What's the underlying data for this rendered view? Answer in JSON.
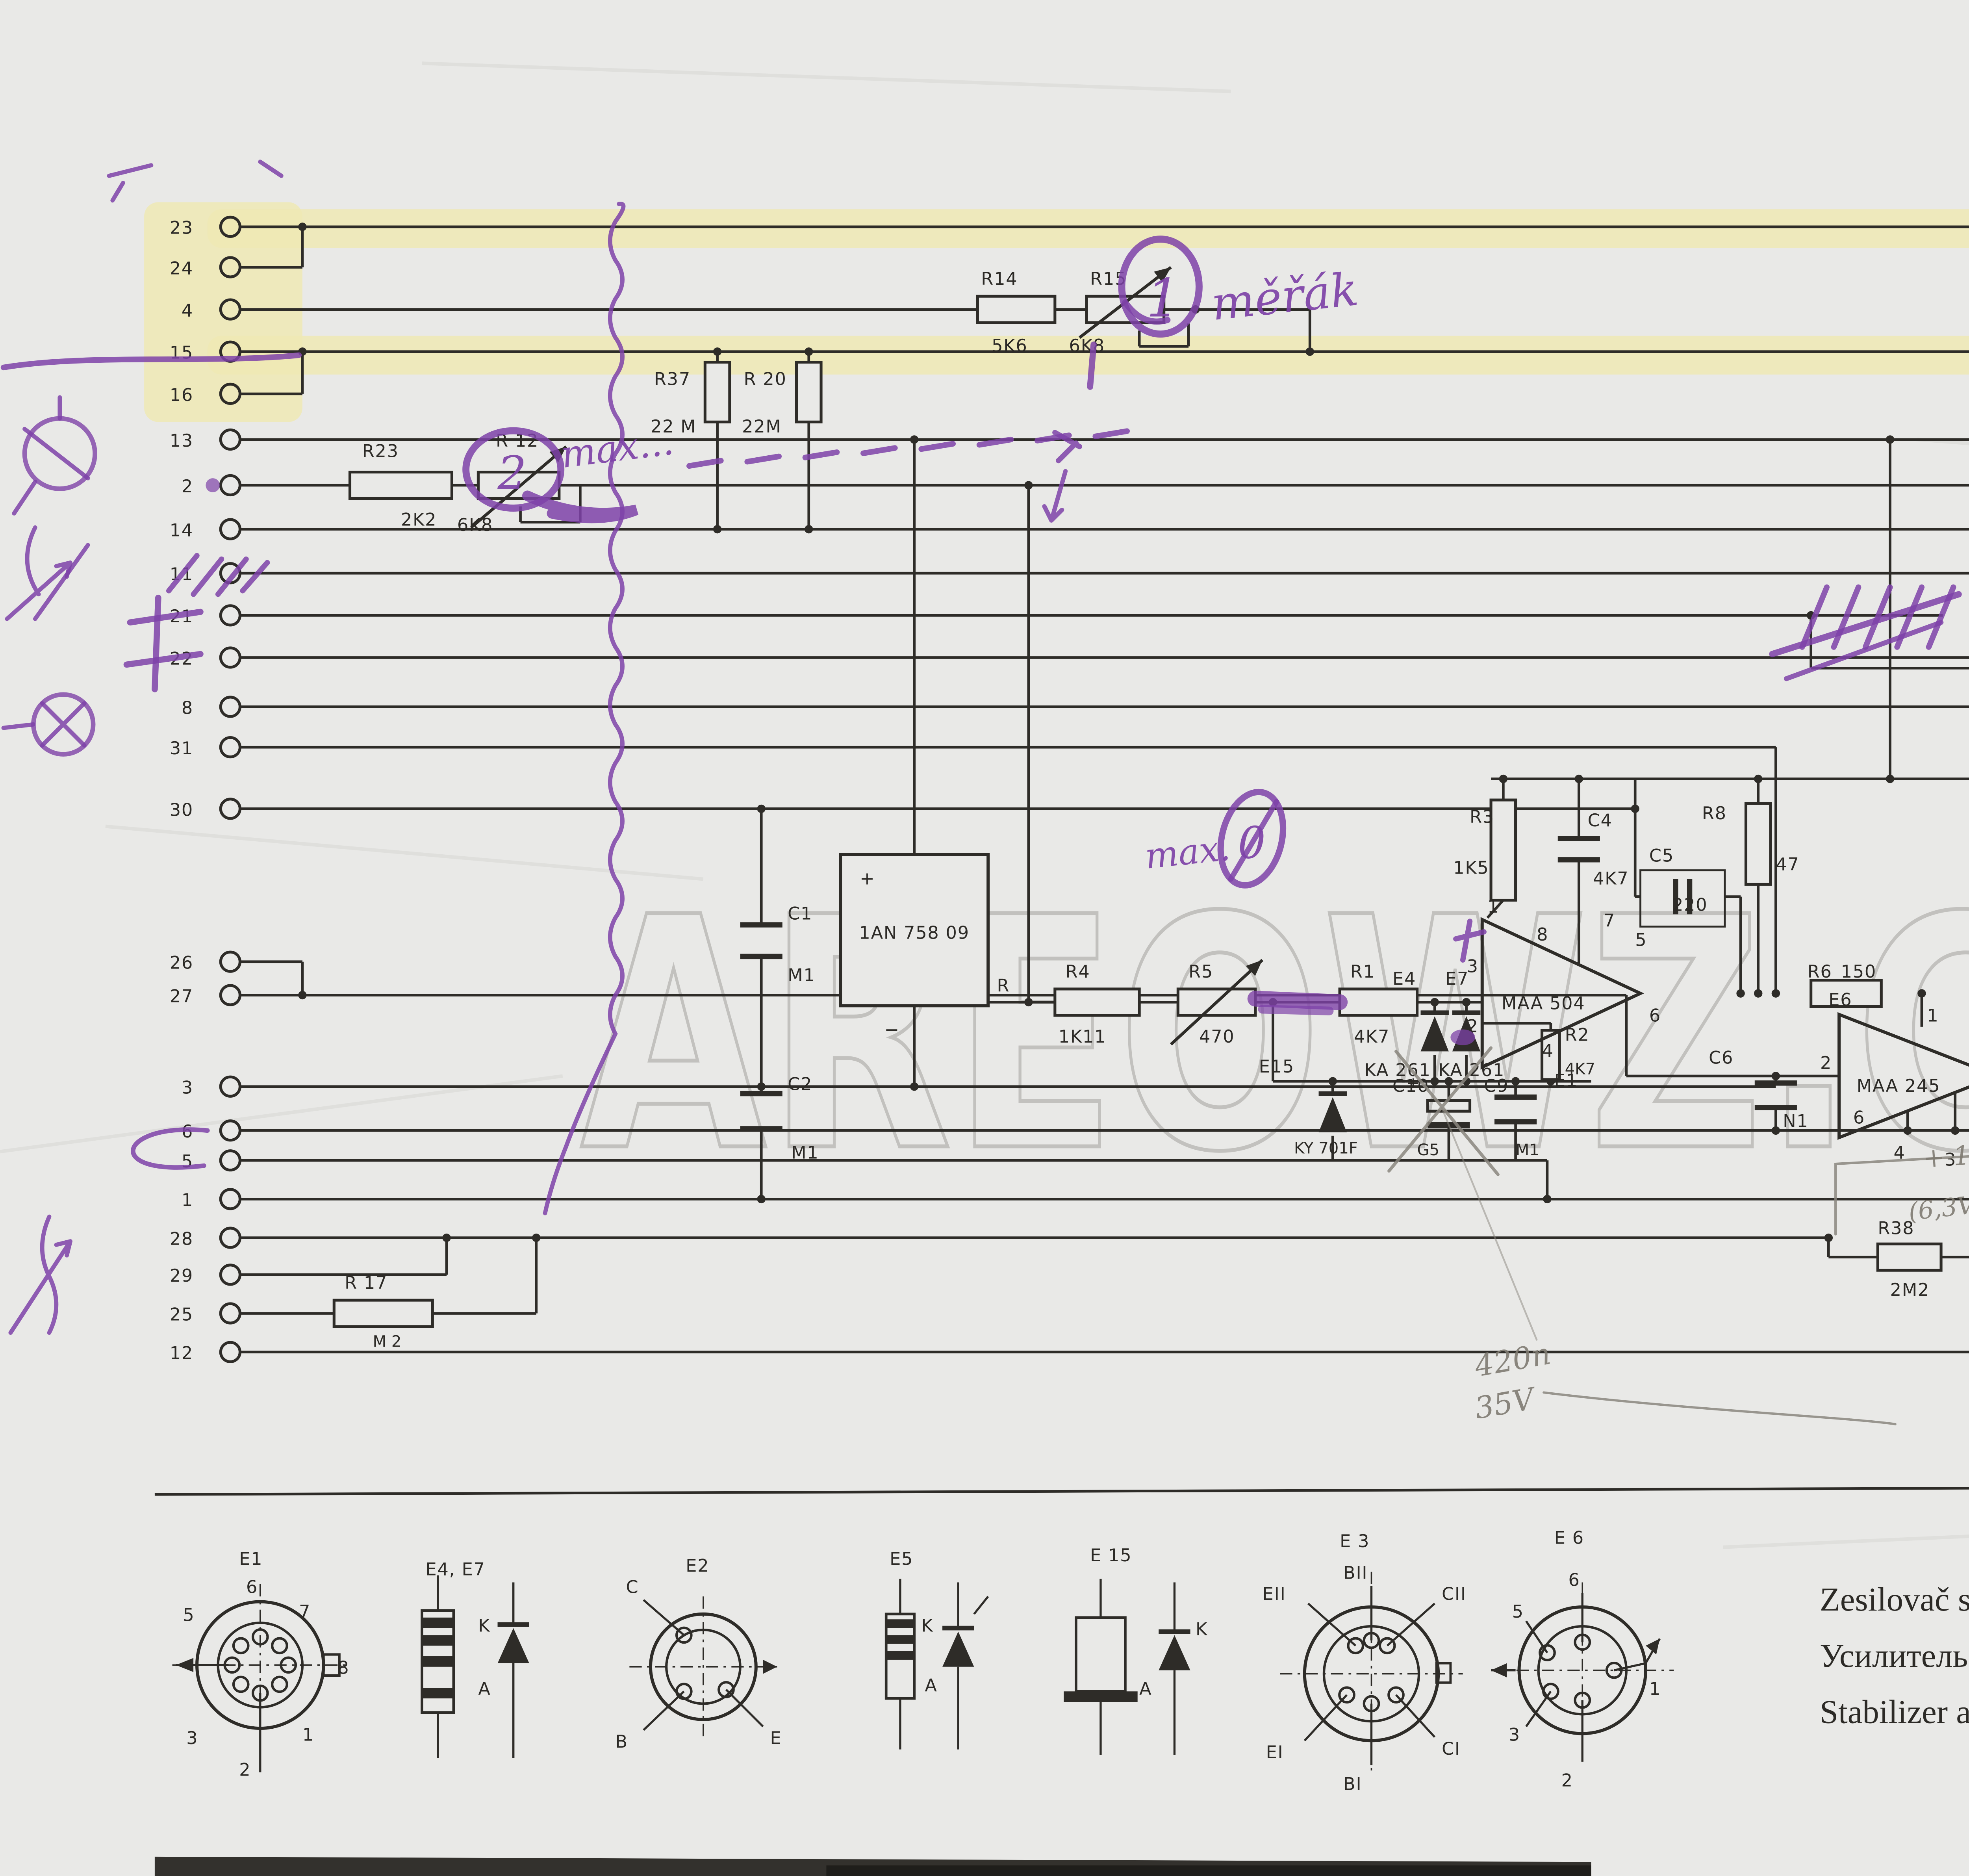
{
  "watermark": "AREOWZ.CZ",
  "pins": {
    "labels": [
      "23",
      "24",
      "4",
      "15",
      "16",
      "13",
      "2",
      "14",
      "11",
      "21",
      "22",
      "8",
      "31",
      "30",
      "26",
      "27",
      "3",
      "6",
      "5",
      "1",
      "28",
      "29",
      "25",
      "12"
    ]
  },
  "components": {
    "R14": {
      "name": "R14",
      "value": "5K6"
    },
    "R15": {
      "name": "R15",
      "value": "6K8"
    },
    "R37": {
      "name": "R37",
      "value": "22 M"
    },
    "R20": {
      "name": "R 20",
      "value": "22M"
    },
    "R23": {
      "name": "R23",
      "value": "2K2"
    },
    "R12": {
      "name": "R 12",
      "value": "6K8"
    },
    "R16": {
      "name": "R 16",
      "value": "2J2"
    },
    "R13": {
      "name": "R 13",
      "value": "100"
    },
    "R22": {
      "name": "R 22",
      "value": "2J2"
    },
    "R10": {
      "name": "R 10",
      "value": "220"
    },
    "R9": {
      "name": "R9",
      "value": "2K2"
    },
    "R4": {
      "name": "R4",
      "value": "1K11"
    },
    "R5": {
      "name": "R5",
      "value": "470"
    },
    "R1": {
      "name": "R1",
      "value": "4K7"
    },
    "R2": {
      "name": "R2",
      "value": "4K7"
    },
    "R3": {
      "name": "R3",
      "value": "1K5"
    },
    "R6": {
      "name": "R6",
      "value": "150"
    },
    "R7": {
      "name": "R7",
      "value": "270"
    },
    "R8": {
      "name": "R8",
      "value": "47"
    },
    "R38": {
      "name": "R38",
      "value": "2M2"
    },
    "R17": {
      "name": "R 17",
      "value": "M 2"
    },
    "C1": {
      "name": "C1",
      "value": "M1"
    },
    "C2": {
      "name": "C2",
      "value": "M1"
    },
    "C4": {
      "name": "C4",
      "value": "4K7"
    },
    "C5": {
      "name": "C5",
      "value": "220"
    },
    "C6": {
      "name": "C6",
      "value": "N1"
    },
    "C7": {
      "name": "C7",
      "value": "47"
    },
    "C8": {
      "name": "C8",
      "value": "4K7"
    },
    "C9": {
      "name": "C9",
      "value": "M1"
    },
    "C10": {
      "name": "C10",
      "value": "G5"
    },
    "IC": {
      "name": "1AN 758 09"
    },
    "E1": {
      "name": "E1",
      "value": "MAA 504"
    },
    "E2": {
      "name": "E2",
      "value": "KF508"
    },
    "E3": {
      "name": "E3",
      "value": "KC 510"
    },
    "E4": {
      "name": "E4",
      "value": "KA 261"
    },
    "E5": {
      "name": "E5",
      "value": "KZ 141"
    },
    "E6": {
      "name": "E6",
      "value": "MAA 245"
    },
    "E7": {
      "name": "E7",
      "value": "KA 261"
    },
    "E15": {
      "name": "E15",
      "value": "KY 701F"
    }
  },
  "ic_marks": {
    "plus": "+",
    "minus": "−",
    "out": "R"
  },
  "ink": {
    "plus": "+"
  },
  "terminals": {
    "e1": [
      "1",
      "3",
      "2",
      "8",
      "7",
      "5",
      "6",
      "4"
    ],
    "e6": [
      "1",
      "2",
      "6",
      "4",
      "3",
      "5"
    ],
    "e3": [
      "KII",
      "KI",
      "BII",
      "BI",
      "EII",
      "EI"
    ]
  },
  "legend": {
    "e1": {
      "title": "E1",
      "pins": [
        "6",
        "5",
        "7",
        "8",
        "1",
        "3",
        "2"
      ]
    },
    "e4e7": {
      "title": "E4, E7",
      "k": "K",
      "a": "A"
    },
    "e2": {
      "title": "E2",
      "c": "C",
      "b": "B",
      "e": "E"
    },
    "e5": {
      "title": "E5",
      "k": "K",
      "a": "A"
    },
    "e15": {
      "title": "E 15",
      "k": "K",
      "a": "A"
    },
    "e3": {
      "title": "E 3",
      "terms": [
        "BII",
        "EII",
        "CII",
        "EI",
        "CI",
        "BI"
      ]
    },
    "e6": {
      "title": "E 6",
      "pins": [
        "6",
        "5",
        "3",
        "2",
        "1"
      ]
    }
  },
  "title_block": {
    "title_cz": "Zesilovač stabilizátoru",
    "title_ru": "Усилитель стабилизатора",
    "title_en": "Stabilizer amplifier",
    "part_number": "1AN 758 57",
    "doc_number": "BS 525/3"
  },
  "annotations": {
    "purple": {
      "merak": "měřák",
      "one": "1",
      "two": "2",
      "zero": "0",
      "max_top": "max...",
      "max_mid": "max.",
      "min": "min."
    },
    "pencil": {
      "cap_plus": "+ 1μF",
      "cap_range": "(6,3V ~ 10V.)",
      "c420": "420n",
      "v35": "35V",
      "uprava": "úprava",
      "range_v": "220mV - 39,5V",
      "range_a": "50mA  1,1A",
      "partial": "dolní jedna…"
    },
    "sketch": {
      "u": "u",
      "n": "n",
      "r12": "R12",
      "r5": "R5",
      "r15": "R15",
      "r10": "R10",
      "tr": "TR"
    }
  }
}
